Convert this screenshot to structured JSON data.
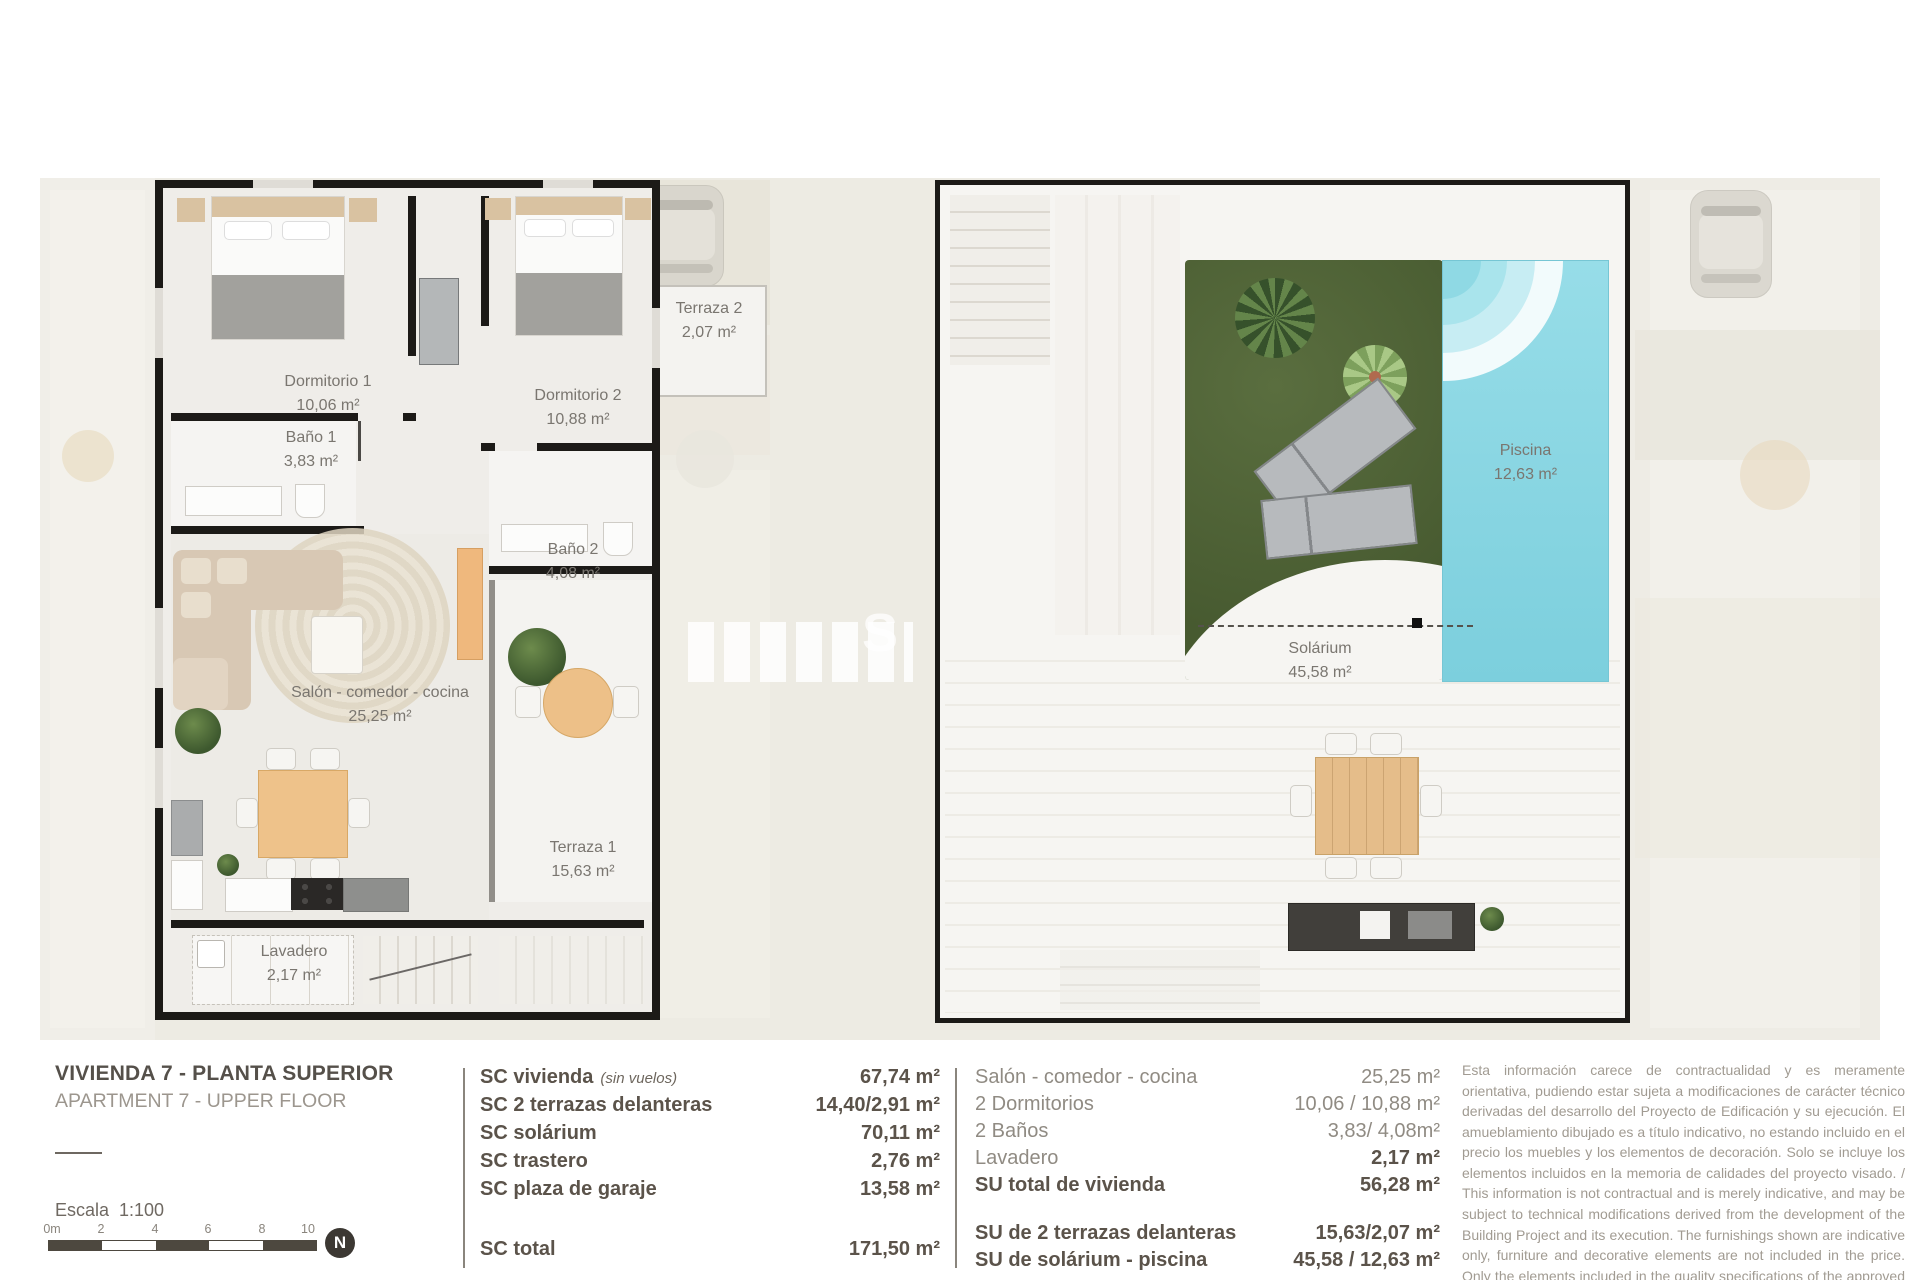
{
  "plans": {
    "left": {
      "rooms": [
        {
          "name": "Dormitorio 1",
          "area": "10,06 m²"
        },
        {
          "name": "Dormitorio 2",
          "area": "10,88 m²"
        },
        {
          "name": "Terraza 2",
          "area": "2,07 m²"
        },
        {
          "name": "Baño 1",
          "area": "3,83 m²"
        },
        {
          "name": "Baño 2",
          "area": "4,08 m²"
        },
        {
          "name": "Salón - comedor - cocina",
          "area": "25,25 m²"
        },
        {
          "name": "Terraza 1",
          "area": "15,63 m²"
        },
        {
          "name": "Lavadero",
          "area": "2,17 m²"
        }
      ]
    },
    "right": {
      "rooms": [
        {
          "name": "Piscina",
          "area": "12,63 m²"
        },
        {
          "name": "Solárium",
          "area": "45,58 m²"
        }
      ]
    }
  },
  "title_block": {
    "title": "VIVIENDA 7 - PLANTA SUPERIOR",
    "subtitle": "APARTMENT 7 - UPPER FLOOR",
    "scale_label": "Escala  1:100",
    "scale_ticks": [
      "0m",
      "2",
      "4",
      "6",
      "8",
      "10"
    ],
    "north_letter": "N"
  },
  "sc_table": {
    "rows": [
      {
        "label": "SC vivienda",
        "note": "(sin vuelos)",
        "value": "67,74 m²"
      },
      {
        "label": "SC 2 terrazas delanteras",
        "note": "",
        "value": "14,40/2,91 m²"
      },
      {
        "label": "SC solárium",
        "note": "",
        "value": "70,11 m²"
      },
      {
        "label": "SC trastero",
        "note": "",
        "value": "2,76 m²"
      },
      {
        "label": "SC plaza de garaje",
        "note": "",
        "value": "13,58 m²"
      }
    ],
    "total": {
      "label": "SC total",
      "value": "171,50 m²"
    }
  },
  "su_table": {
    "rows": [
      {
        "label": "Salón - comedor - cocina",
        "value": "25,25 m²"
      },
      {
        "label": "2 Dormitorios",
        "value": "10,06 / 10,88 m²"
      },
      {
        "label": "2 Baños",
        "value": "3,83/ 4,08m²"
      },
      {
        "label": "Lavadero",
        "value": "2,17 m²"
      },
      {
        "label": "SU total de vivienda",
        "value": "56,28 m²"
      }
    ],
    "extra_rows": [
      {
        "label": "SU de 2 terrazas delanteras",
        "value": "15,63/2,07 m²"
      },
      {
        "label": "SU de solárium - piscina",
        "value": "45,58 / 12,63 m²"
      }
    ]
  },
  "disclaimer": {
    "text": "Esta información carece de contractualidad y es meramente orientativa, pudiendo estar sujeta a modificaciones de carácter técnico derivadas del desarrollo del Proyecto de Edificación y su ejecución. El amueblamiento dibujado es a título indicativo, no estando incluido en el precio los muebles y los elementos de decoración. Solo se incluye los elementos incluidos en la memoria de calidades del proyecto visado. / This information is not contractual and is merely indicative, and may be subject to technical modifications derived from the development of the Building Project and its execution. The furnishings shown are indicative only, furniture and decorative elements are not included in the price. Only the elements included in the quality specifications of the approved project are included."
  },
  "watermark": {
    "letter": "S"
  }
}
